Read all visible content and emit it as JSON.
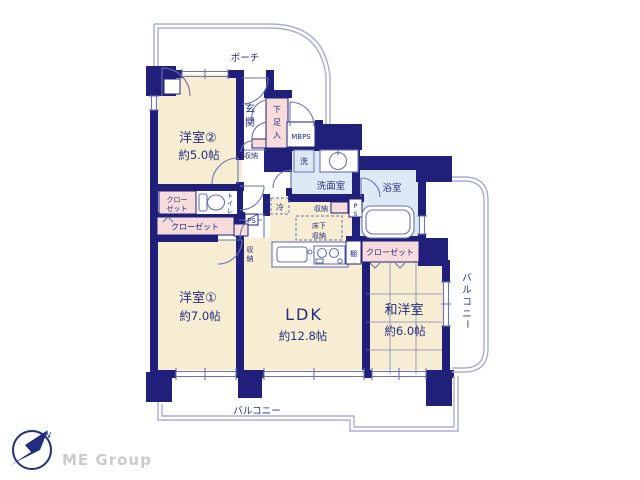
{
  "colors": {
    "wall": "#20207a",
    "cream": "#f7edd2",
    "pink": "#f8dcdc",
    "wet": "#dde9f5",
    "line": "#6a73b0",
    "boundary": "#a8aed6",
    "text": "#232d7d",
    "logo": "#cbcbce"
  },
  "plan": {
    "porch": "ポーチ",
    "balcony": "バルコニー",
    "balcony_side": "バルコニー",
    "rooms": {
      "western2": {
        "name": "洋室②",
        "size": "約5.0帖"
      },
      "western1": {
        "name": "洋室①",
        "size": "約7.0帖"
      },
      "ldk": {
        "name": "LDK",
        "size": "約12.8帖"
      },
      "japanese": {
        "name": "和洋室",
        "size": "約6.0帖"
      }
    },
    "entrance": "玄関",
    "shoe_cabinet": "下足入",
    "meter_box": "MBPS",
    "entrance_storage": "収納",
    "washer": "洗",
    "washroom": "洗面室",
    "bathroom": "浴室",
    "pipe_space_right": "PS",
    "washroom_storage": "収納",
    "underfloor": {
      "line1": "床下",
      "line2": "収納"
    },
    "fridge": "冷",
    "toilet": "トイレ",
    "closet_upper": {
      "line1": "クロー",
      "line2": "ゼット"
    },
    "closet_left": "クローゼット",
    "pipe_space_hall": "PS",
    "hall_storage": "収納",
    "shelf": "棚",
    "closet_east": "クローゼット",
    "compass_north": "N",
    "brand": "ME Group"
  }
}
